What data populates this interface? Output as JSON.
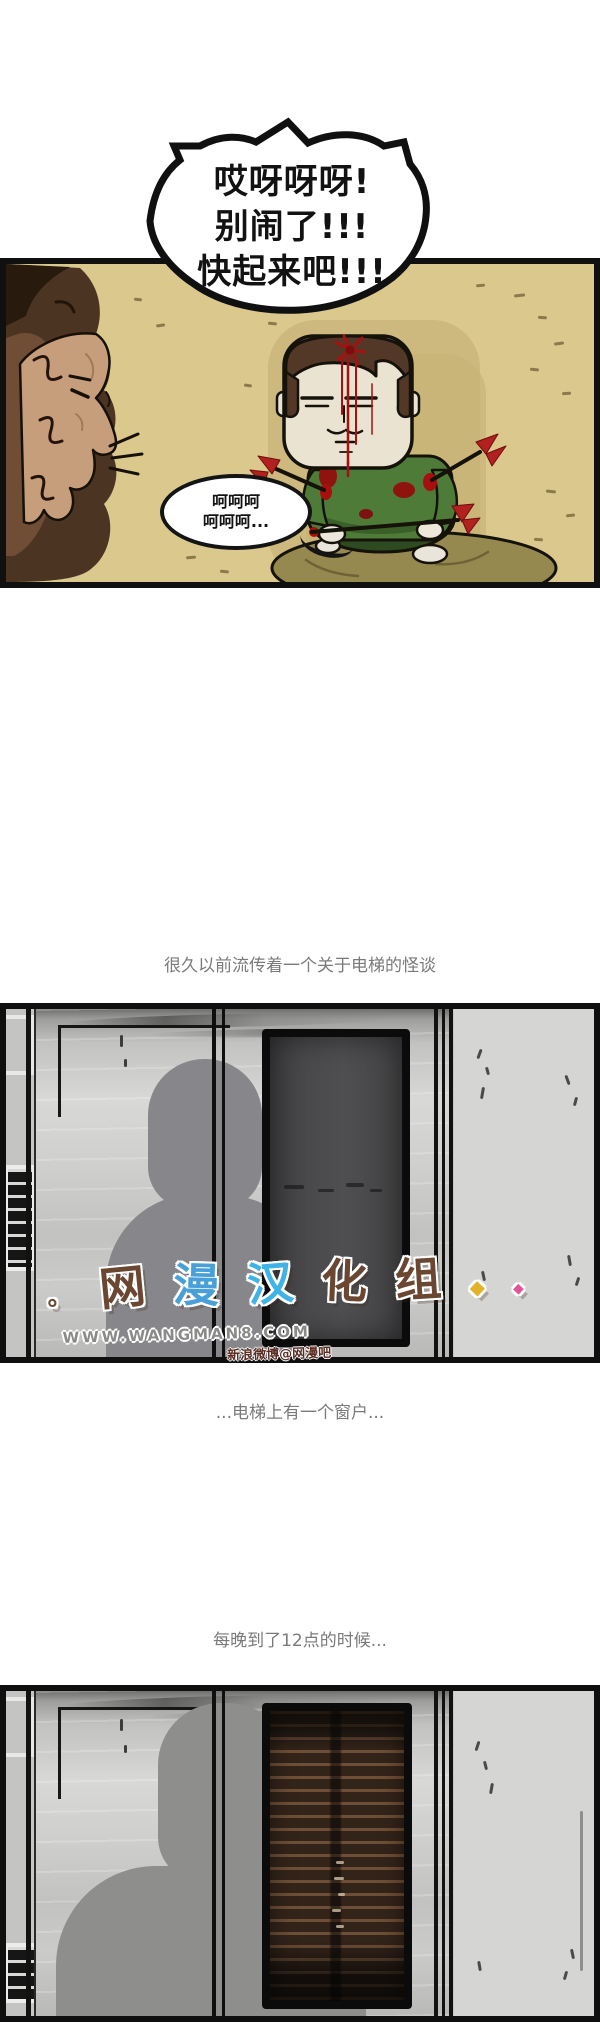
{
  "comic": {
    "speech_bubble": {
      "line1": "哎呀呀呀!",
      "line2": "别闹了!!!",
      "line3": "快起来吧!!!"
    },
    "small_bubble": {
      "line1": "呵呵呵",
      "line2": "呵呵呵..."
    },
    "captions": {
      "legend": "很久以前流传着一个关于电梯的怪谈",
      "window": "...电梯上有一个窗户...",
      "midnight": "每晚到了12点的时候..."
    },
    "watermark": {
      "dot": "。",
      "logo_char1": "网",
      "logo_char2": "漫",
      "logo_char3": "汉",
      "logo_char4": "化",
      "logo_char5": "组",
      "diamond1": "◆",
      "diamond2": "◆",
      "url": "WWW.WANGMAN8.COM",
      "weibo_tag": "新浪微博@网漫吧"
    },
    "colors": {
      "panel1_bg": "#dbc88d",
      "blood_red": "#a81010",
      "sweater_green": "#4e7b38",
      "cushion_olive": "#96894f",
      "elevator_wall": "#c6c6c4",
      "window_dark": "#46464a",
      "window_brown": "#33241a",
      "caption_gray": "#7a7a7a",
      "watermark_blue": "#49a0d8",
      "watermark_brown": "#6b4732",
      "watermark_pink": "#e0559a",
      "watermark_yellow": "#e2b32a"
    }
  }
}
